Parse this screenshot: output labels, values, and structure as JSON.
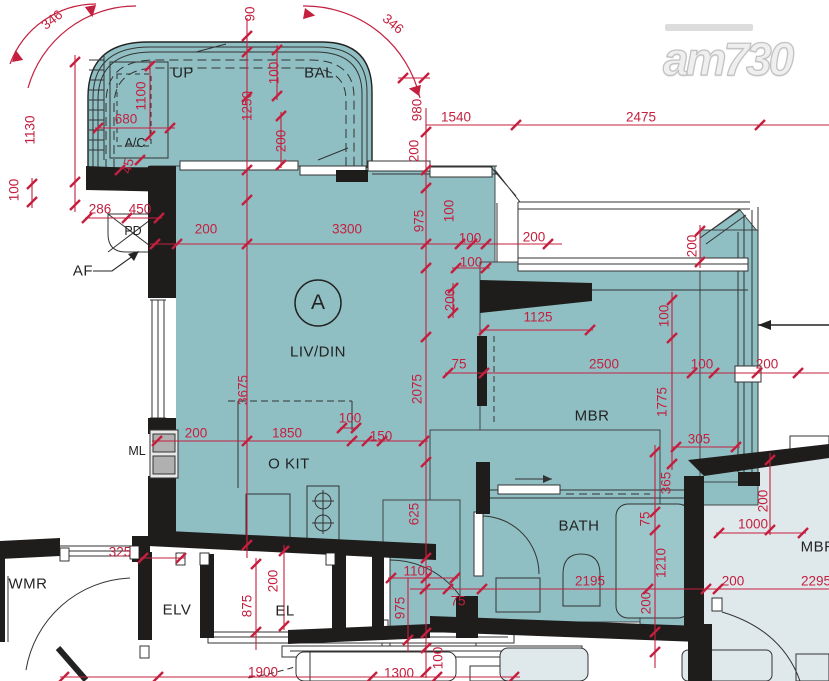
{
  "logo": {
    "text": "am730"
  },
  "unit": {
    "label": "A"
  },
  "colors": {
    "unit_fill": "#8fbfc3",
    "adjacent_fill": "#dfe9ec",
    "wall_black": "#1f1c1c",
    "line_dark": "#333333",
    "dim_red": "#c41f3e",
    "logo_gray": "#dedede",
    "appliance_gray": "#b0b0b0"
  },
  "labels": [
    {
      "t": "346",
      "x": 52,
      "y": 20,
      "r": -38,
      "k": "dim"
    },
    {
      "t": "90",
      "x": 250,
      "y": 14,
      "r": -90,
      "k": "dim"
    },
    {
      "t": "346",
      "x": 393,
      "y": 24,
      "r": 40,
      "k": "dim"
    },
    {
      "t": "1130",
      "x": 30,
      "y": 130,
      "r": -90,
      "k": "dim"
    },
    {
      "t": "100",
      "x": 14,
      "y": 190,
      "r": -90,
      "k": "dim"
    },
    {
      "t": "1100",
      "x": 141,
      "y": 96,
      "r": -90,
      "k": "dim"
    },
    {
      "t": "680",
      "x": 126,
      "y": 119,
      "r": 0,
      "k": "dim"
    },
    {
      "t": "1250",
      "x": 247,
      "y": 106,
      "r": -90,
      "k": "dim"
    },
    {
      "t": "100",
      "x": 274,
      "y": 73,
      "r": -90,
      "k": "dim"
    },
    {
      "t": "200",
      "x": 281,
      "y": 141,
      "r": -90,
      "k": "dim"
    },
    {
      "t": "980",
      "x": 417,
      "y": 110,
      "r": -90,
      "k": "dim"
    },
    {
      "t": "200",
      "x": 414,
      "y": 151,
      "r": -90,
      "k": "dim"
    },
    {
      "t": "1540",
      "x": 456,
      "y": 117,
      "r": 0,
      "k": "dim"
    },
    {
      "t": "2475",
      "x": 641,
      "y": 117,
      "r": 0,
      "k": "dim"
    },
    {
      "t": "45",
      "x": 128,
      "y": 166,
      "r": -75,
      "k": "dim"
    },
    {
      "t": "286",
      "x": 100,
      "y": 209,
      "r": 0,
      "k": "dim"
    },
    {
      "t": "450",
      "x": 140,
      "y": 209,
      "r": 0,
      "k": "dim"
    },
    {
      "t": "200",
      "x": 206,
      "y": 229,
      "r": 0,
      "k": "dim"
    },
    {
      "t": "3300",
      "x": 347,
      "y": 229,
      "r": 0,
      "k": "dim"
    },
    {
      "t": "975",
      "x": 419,
      "y": 221,
      "r": -90,
      "k": "dim"
    },
    {
      "t": "100",
      "x": 449,
      "y": 211,
      "r": -90,
      "k": "dim"
    },
    {
      "t": "100",
      "x": 470,
      "y": 238,
      "r": 0,
      "k": "dim"
    },
    {
      "t": "200",
      "x": 534,
      "y": 237,
      "r": 0,
      "k": "dim"
    },
    {
      "t": "100",
      "x": 471,
      "y": 262,
      "r": 0,
      "k": "dim"
    },
    {
      "t": "200",
      "x": 450,
      "y": 300,
      "r": -90,
      "k": "dim"
    },
    {
      "t": "200",
      "x": 692,
      "y": 246,
      "r": -90,
      "k": "dim"
    },
    {
      "t": "3675",
      "x": 243,
      "y": 390,
      "r": -90,
      "k": "dim"
    },
    {
      "t": "2075",
      "x": 417,
      "y": 389,
      "r": -90,
      "k": "dim"
    },
    {
      "t": "1125",
      "x": 538,
      "y": 317,
      "r": 0,
      "k": "dim"
    },
    {
      "t": "75",
      "x": 459,
      "y": 364,
      "r": 0,
      "k": "dim"
    },
    {
      "t": "2500",
      "x": 604,
      "y": 364,
      "r": 0,
      "k": "dim"
    },
    {
      "t": "100",
      "x": 702,
      "y": 364,
      "r": 0,
      "k": "dim"
    },
    {
      "t": "200",
      "x": 767,
      "y": 364,
      "r": 0,
      "k": "dim"
    },
    {
      "t": "100",
      "x": 664,
      "y": 316,
      "r": -90,
      "k": "dim"
    },
    {
      "t": "1775",
      "x": 662,
      "y": 402,
      "r": -90,
      "k": "dim"
    },
    {
      "t": "305",
      "x": 699,
      "y": 439,
      "r": 0,
      "k": "dim"
    },
    {
      "t": "365",
      "x": 666,
      "y": 483,
      "r": -90,
      "k": "dim"
    },
    {
      "t": "75",
      "x": 645,
      "y": 519,
      "r": -90,
      "k": "dim"
    },
    {
      "t": "1210",
      "x": 661,
      "y": 563,
      "r": -90,
      "k": "dim"
    },
    {
      "t": "200",
      "x": 646,
      "y": 603,
      "r": -90,
      "k": "dim"
    },
    {
      "t": "200",
      "x": 763,
      "y": 501,
      "r": -90,
      "k": "dim"
    },
    {
      "t": "1000",
      "x": 753,
      "y": 524,
      "r": 0,
      "k": "dim"
    },
    {
      "t": "200",
      "x": 733,
      "y": 581,
      "r": 0,
      "k": "dim"
    },
    {
      "t": "2295",
      "x": 816,
      "y": 581,
      "r": 0,
      "k": "dim"
    },
    {
      "t": "2195",
      "x": 590,
      "y": 581,
      "r": 0,
      "k": "dim"
    },
    {
      "t": "100",
      "x": 350,
      "y": 418,
      "r": 0,
      "k": "dim"
    },
    {
      "t": "200",
      "x": 196,
      "y": 433,
      "r": 0,
      "k": "dim"
    },
    {
      "t": "1850",
      "x": 287,
      "y": 433,
      "r": 0,
      "k": "dim"
    },
    {
      "t": "150",
      "x": 381,
      "y": 436,
      "r": 0,
      "k": "dim"
    },
    {
      "t": "625",
      "x": 414,
      "y": 514,
      "r": -90,
      "k": "dim"
    },
    {
      "t": "325",
      "x": 120,
      "y": 552,
      "r": 0,
      "k": "dim"
    },
    {
      "t": "200",
      "x": 273,
      "y": 581,
      "r": -90,
      "k": "dim"
    },
    {
      "t": "875",
      "x": 247,
      "y": 606,
      "r": -90,
      "k": "dim"
    },
    {
      "t": "1100",
      "x": 418,
      "y": 571,
      "r": 0,
      "k": "dim"
    },
    {
      "t": "975",
      "x": 400,
      "y": 608,
      "r": -90,
      "k": "dim"
    },
    {
      "t": "75",
      "x": 458,
      "y": 601,
      "r": 0,
      "k": "dim"
    },
    {
      "t": "100",
      "x": 438,
      "y": 658,
      "r": -90,
      "k": "dim"
    },
    {
      "t": "1900",
      "x": 263,
      "y": 672,
      "r": 0,
      "k": "dim"
    },
    {
      "t": "1300",
      "x": 399,
      "y": 673,
      "r": 0,
      "k": "dim"
    },
    {
      "t": "UP",
      "x": 183,
      "y": 73,
      "r": 0,
      "k": "room"
    },
    {
      "t": "BAL",
      "x": 319,
      "y": 73,
      "r": 0,
      "k": "room"
    },
    {
      "t": "A/C",
      "x": 135,
      "y": 143,
      "r": 0,
      "k": "room-sm"
    },
    {
      "t": "PD",
      "x": 133,
      "y": 231,
      "r": 0,
      "k": "room-sm"
    },
    {
      "t": "AF",
      "x": 83,
      "y": 271,
      "r": 0,
      "k": "room"
    },
    {
      "t": "LIV/DIN",
      "x": 318,
      "y": 352,
      "r": 0,
      "k": "room"
    },
    {
      "t": "MBR",
      "x": 592,
      "y": 416,
      "r": 0,
      "k": "room"
    },
    {
      "t": "BATH",
      "x": 579,
      "y": 526,
      "r": 0,
      "k": "room"
    },
    {
      "t": "O KIT",
      "x": 289,
      "y": 464,
      "r": 0,
      "k": "room"
    },
    {
      "t": "ML",
      "x": 137,
      "y": 451,
      "r": 0,
      "k": "room-sm"
    },
    {
      "t": "WMR",
      "x": 28,
      "y": 584,
      "r": 0,
      "k": "room"
    },
    {
      "t": "ELV",
      "x": 177,
      "y": 610,
      "r": 0,
      "k": "room"
    },
    {
      "t": "EL",
      "x": 285,
      "y": 611,
      "r": 0,
      "k": "room"
    },
    {
      "t": "MBR",
      "x": 818,
      "y": 547,
      "r": 0,
      "k": "room"
    }
  ]
}
